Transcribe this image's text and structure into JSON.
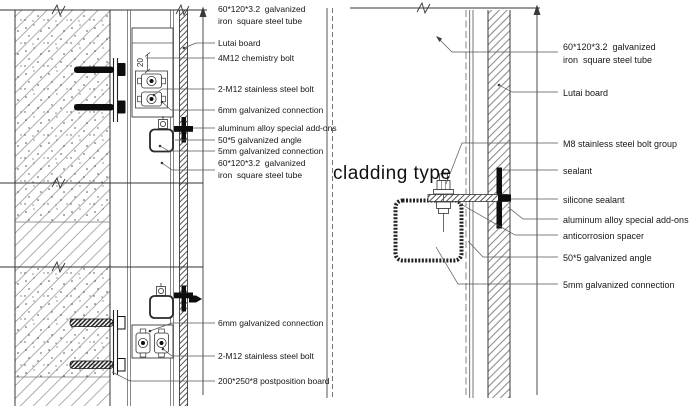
{
  "drawing_title": "cladding type",
  "dimension_label": "20",
  "colors": {
    "background": "#ffffff",
    "line": "#3a3a3a",
    "hatch": "#8a8a8a",
    "solid_fill": "#0d0d0d"
  },
  "left_detail": {
    "labels": [
      {
        "lines": [
          "60*120*3.2  galvanized",
          "iron  square steel tube"
        ]
      },
      {
        "lines": [
          "Lutai board"
        ]
      },
      {
        "lines": [
          "4M12 chemistry bolt"
        ]
      },
      {
        "lines": [
          "2-M12 stainless steel bolt"
        ]
      },
      {
        "lines": [
          "6mm galvanized connection"
        ]
      },
      {
        "lines": [
          "aluminum alloy special add-ons"
        ]
      },
      {
        "lines": [
          "50*5 galvanized angle"
        ]
      },
      {
        "lines": [
          "5mm galvanized connection"
        ]
      },
      {
        "lines": [
          "60*120*3.2  galvanized",
          "iron  square steel tube"
        ]
      },
      {
        "lines": [
          "6mm galvanized connection"
        ]
      },
      {
        "lines": [
          "2-M12 stainless steel bolt"
        ]
      },
      {
        "lines": [
          "200*250*8 postposition board"
        ]
      }
    ]
  },
  "right_detail": {
    "labels": [
      {
        "lines": [
          "60*120*3.2  galvanized",
          "iron  square steel tube"
        ]
      },
      {
        "lines": [
          "Lutai board"
        ]
      },
      {
        "lines": [
          "M8 stainless steel bolt group"
        ]
      },
      {
        "lines": [
          "sealant"
        ]
      },
      {
        "lines": [
          "silicone sealant"
        ]
      },
      {
        "lines": [
          "aluminum alloy special add-ons"
        ]
      },
      {
        "lines": [
          "anticorrosion spacer"
        ]
      },
      {
        "lines": [
          "50*5 galvanized angle"
        ]
      },
      {
        "lines": [
          "5mm galvanized connection"
        ]
      }
    ]
  }
}
